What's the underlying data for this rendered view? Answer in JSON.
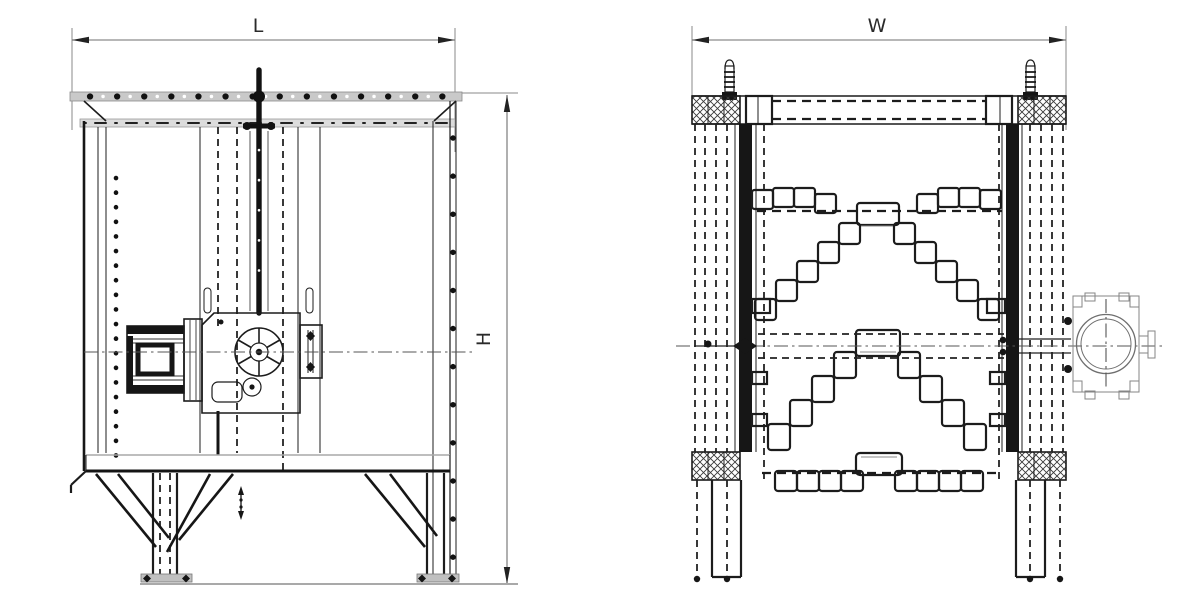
{
  "drawing": {
    "labels": {
      "length": "L",
      "height": "H",
      "width": "W"
    },
    "colors": {
      "line": "#1c1c1c",
      "hidden_line": "#222222",
      "centerline": "#555555",
      "rail_fill": "#c9c9c9",
      "background": "#ffffff"
    }
  }
}
